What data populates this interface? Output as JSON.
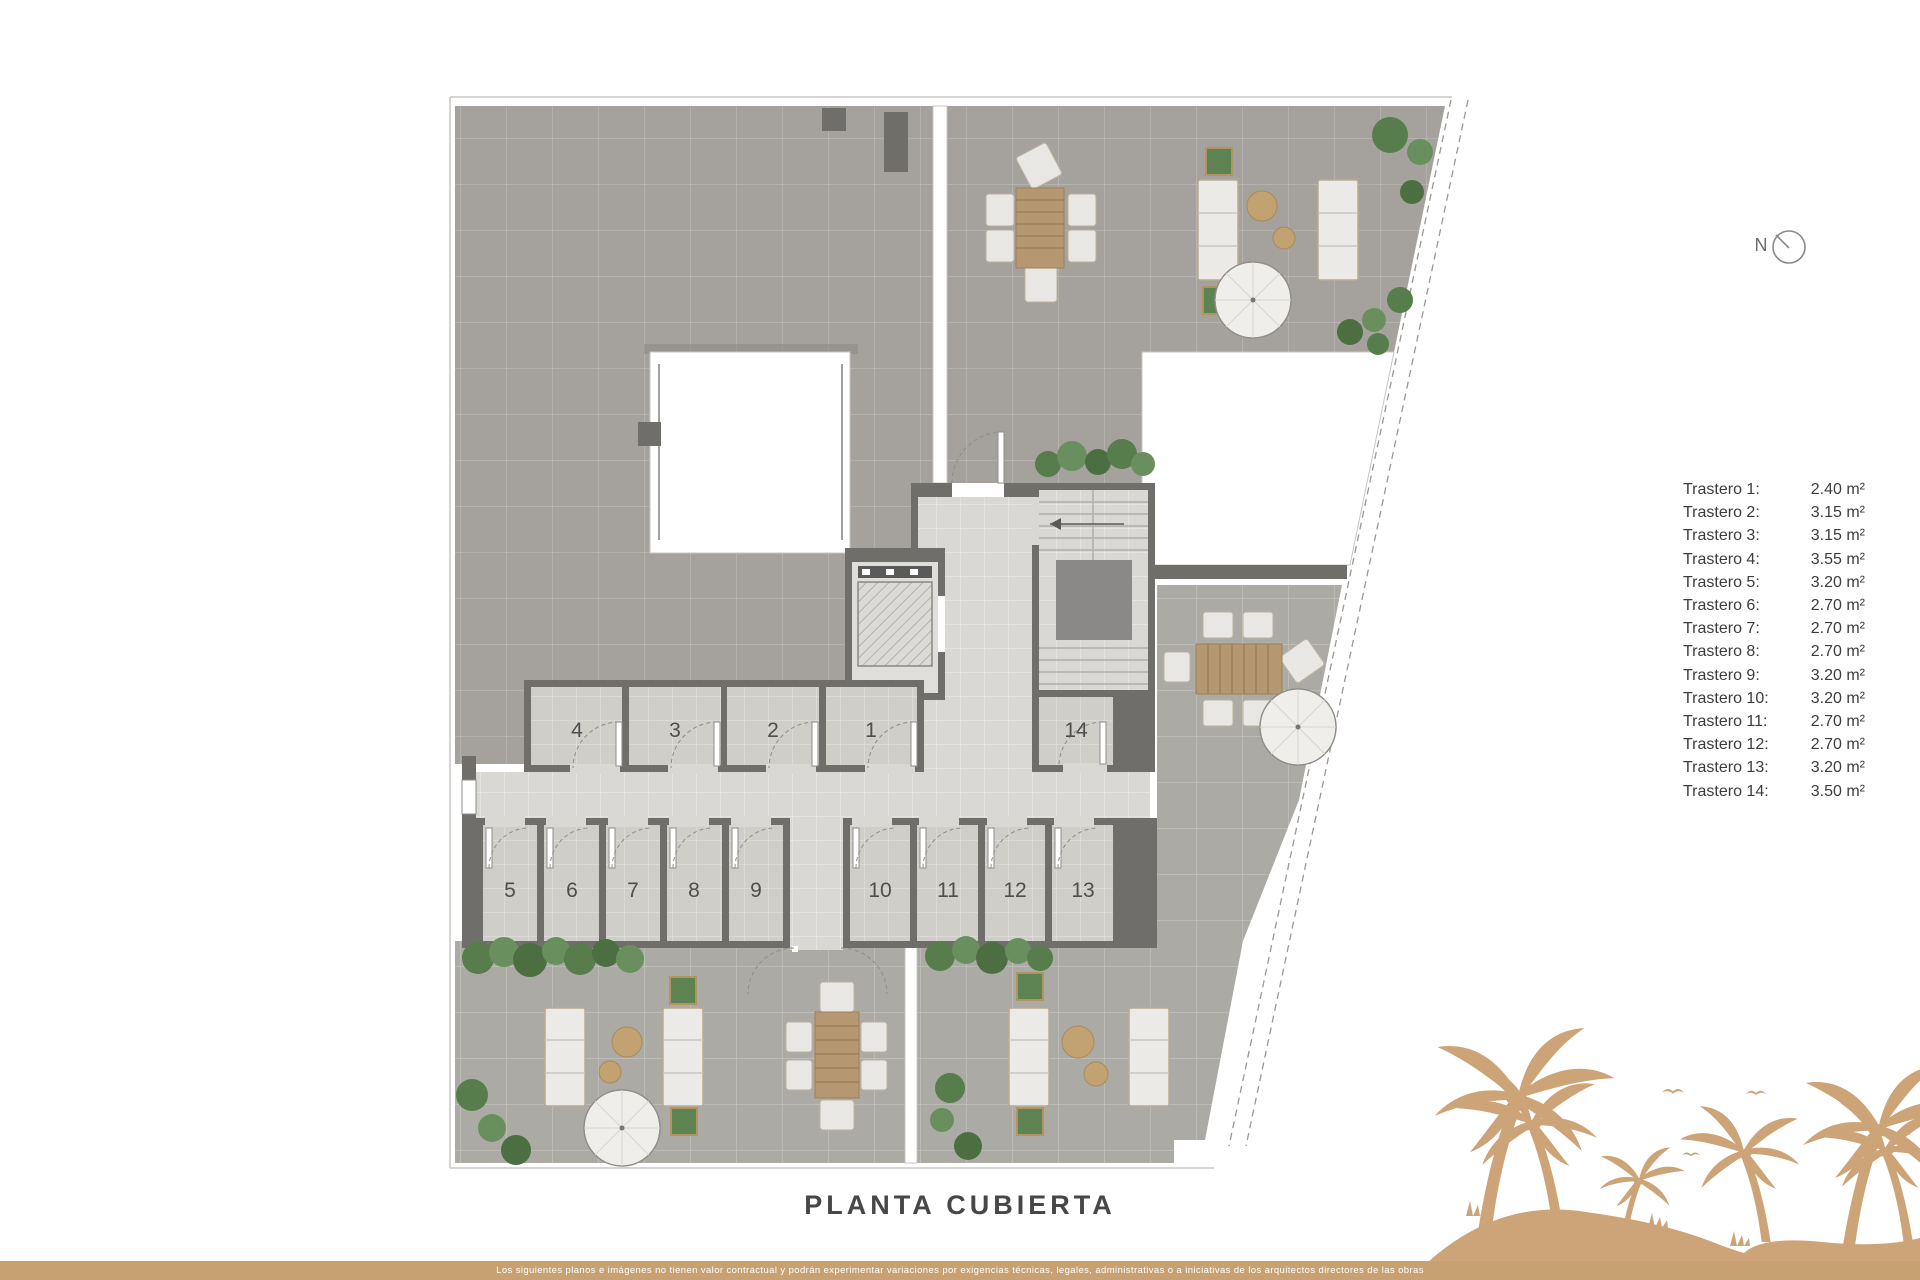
{
  "page": {
    "title": "PLANTA CUBIERTA",
    "footer_disclaimer": "Los siguientes planos e imágenes no tienen valor contractual y podrán experimentar variaciones por exigencias técnicas, legales, administrativas o a iniciativas de los arquitectos directores de las obras"
  },
  "compass": {
    "label": "N"
  },
  "legend": {
    "items": [
      {
        "label": "Trastero 1:",
        "area": "2.40 m²"
      },
      {
        "label": "Trastero 2:",
        "area": "3.15 m²"
      },
      {
        "label": "Trastero 3:",
        "area": "3.15 m²"
      },
      {
        "label": "Trastero 4:",
        "area": "3.55 m²"
      },
      {
        "label": "Trastero 5:",
        "area": "3.20 m²"
      },
      {
        "label": "Trastero 6:",
        "area": "2.70 m²"
      },
      {
        "label": "Trastero 7:",
        "area": "2.70 m²"
      },
      {
        "label": "Trastero 8:",
        "area": "2.70 m²"
      },
      {
        "label": "Trastero 9:",
        "area": "3.20 m²"
      },
      {
        "label": "Trastero 10:",
        "area": "3.20 m²"
      },
      {
        "label": "Trastero 11:",
        "area": "2.70 m²"
      },
      {
        "label": "Trastero 12:",
        "area": "2.70 m²"
      },
      {
        "label": "Trastero 13:",
        "area": "3.20 m²"
      },
      {
        "label": "Trastero 14:",
        "area": "3.50 m²"
      }
    ]
  },
  "plan": {
    "floor_name": "PLANTA CUBIERTA",
    "rooms": [
      {
        "label": "1"
      },
      {
        "label": "2"
      },
      {
        "label": "3"
      },
      {
        "label": "4"
      },
      {
        "label": "5"
      },
      {
        "label": "6"
      },
      {
        "label": "7"
      },
      {
        "label": "8"
      },
      {
        "label": "9"
      },
      {
        "label": "10"
      },
      {
        "label": "11"
      },
      {
        "label": "12"
      },
      {
        "label": "13"
      },
      {
        "label": "14"
      }
    ]
  },
  "colors": {
    "accent_tan": "#c7a171",
    "palm_tan": "#cda378",
    "wall_gray": "#6f6e6b",
    "terrace_gray": "#a5a29d",
    "floor_light": "#dad8d4",
    "plant_green": "#567d4b",
    "wood": "#b59872"
  }
}
